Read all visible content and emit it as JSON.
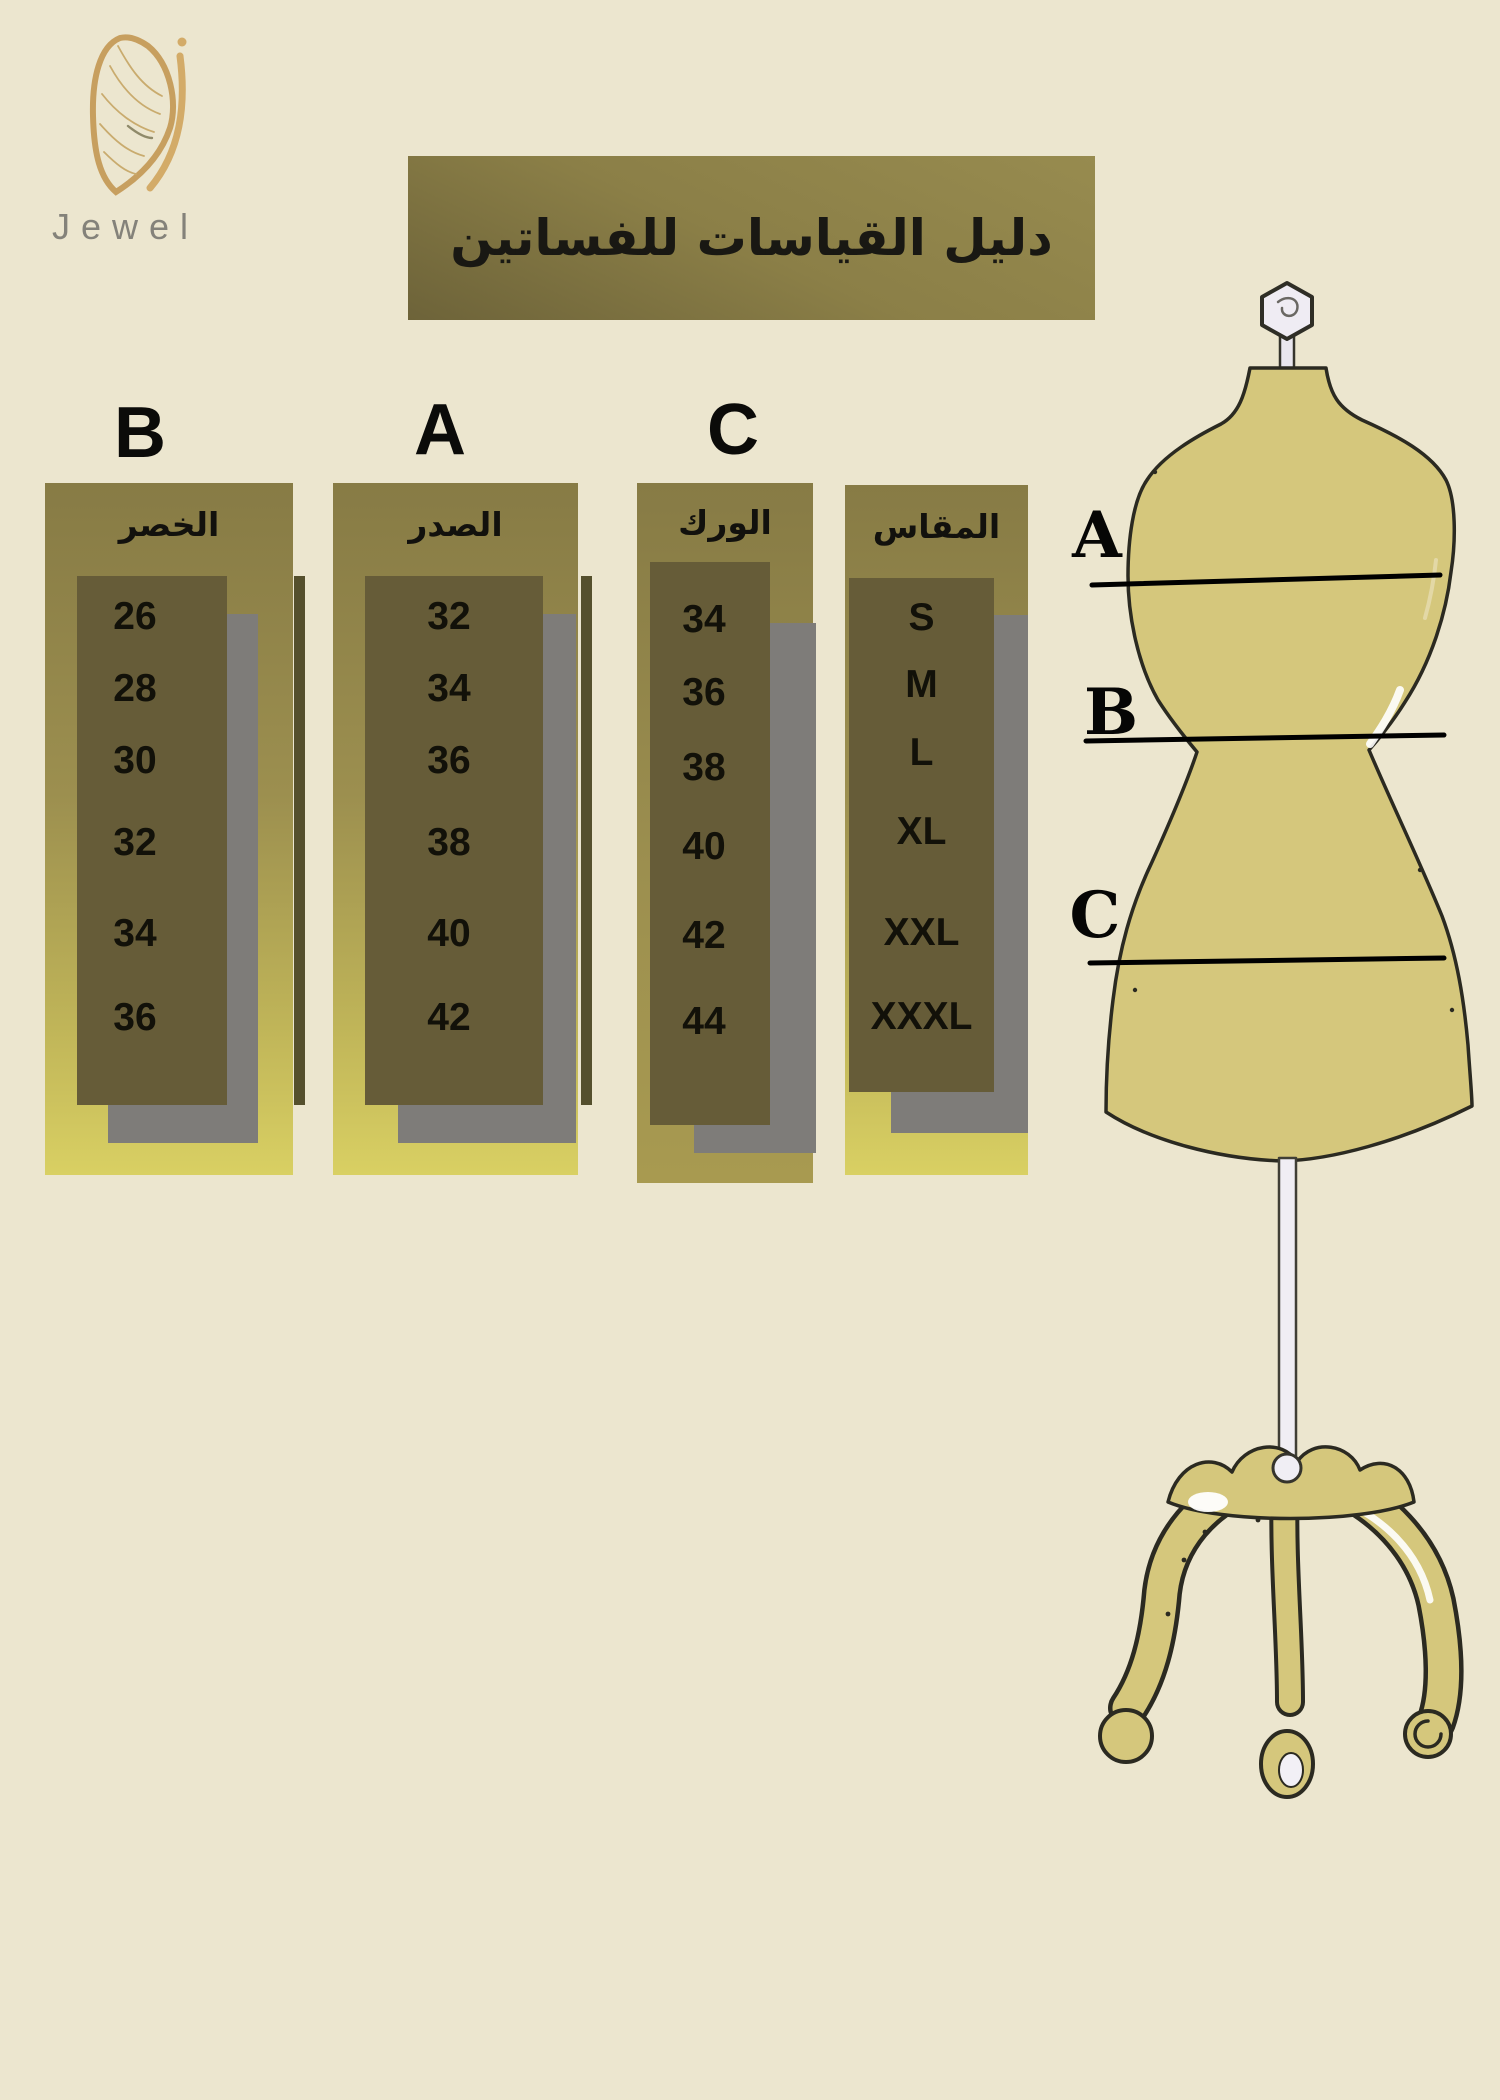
{
  "brand": {
    "name": "Jewel"
  },
  "banner": {
    "title": "دليل القياسات للفساتين"
  },
  "size_guide": {
    "columns": [
      {
        "letter": "B",
        "header": "الخصر",
        "values": [
          "26",
          "28",
          "30",
          "32",
          "34",
          "36"
        ]
      },
      {
        "letter": "A",
        "header": "الصدر",
        "values": [
          "32",
          "34",
          "36",
          "38",
          "40",
          "42"
        ]
      },
      {
        "letter": "C",
        "header": "الورك",
        "values": [
          "34",
          "36",
          "38",
          "40",
          "42",
          "44"
        ]
      },
      {
        "letter": "",
        "header": "المقاس",
        "values": [
          "S",
          "M",
          "L",
          "XL",
          "XXL",
          "XXXL"
        ]
      }
    ]
  },
  "mannequin": {
    "labels": [
      "A",
      "B",
      "C"
    ]
  },
  "colors": {
    "bg": "#ece6cf",
    "banner-b": "#8b7f47",
    "panel-top": "#877b45",
    "panel-bottom": "#d9d063",
    "cell-dark": "#665c38",
    "shadow-gray": "#7e7c79",
    "strip-dark": "#55502d",
    "body-tan": "#d5c77c",
    "logo-gold": "#cfa567",
    "logo-text": "#84827a"
  }
}
